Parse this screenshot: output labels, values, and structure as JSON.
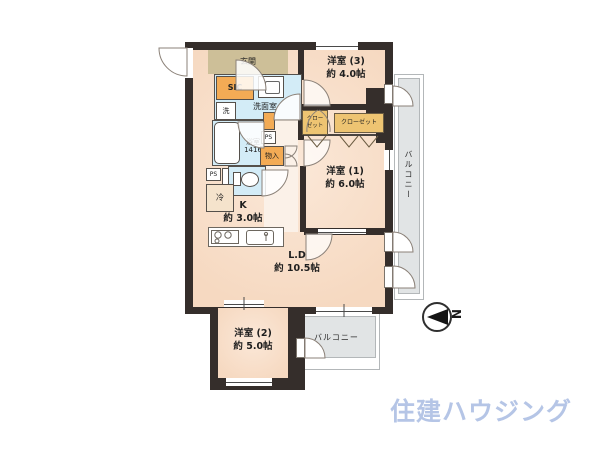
{
  "plan": {
    "labels": {
      "entrance": "玄関",
      "sic": "SIC",
      "washroom": "洗面室",
      "washer": "洗",
      "bath_name": "浴室",
      "bath_size": "1416",
      "ps": "PS",
      "storage": "物入",
      "fridge": "冷",
      "kitchen_name": "K",
      "kitchen_area": "約 3.0帖",
      "ld_name": "L.D",
      "ld_area": "約 10.5帖",
      "w1_name": "洋室 (1)",
      "w1_area": "約 6.0帖",
      "w2_name": "洋室 (2)",
      "w2_area": "約 5.0帖",
      "w3_name": "洋室 (3)",
      "w3_area": "約 4.0帖",
      "closet_small_line1": "クロー",
      "closet_small_line2": "ゼット",
      "closet_wide": "クローゼット",
      "balcony_right": "バルコニー",
      "balcony_bottom": "バルコニー"
    },
    "compass": {
      "north": "N"
    },
    "colors": {
      "wall": "#352e2b",
      "floor": "#f6d9c1",
      "wet_area": "#d3ecf7",
      "accent_orange": "#f3ab55",
      "closet": "#eec472",
      "entrance_tan": "#cdbf98",
      "balcony_grey": "#e1e4e5",
      "logo_blue": "#b5c5e6"
    }
  },
  "footer": {
    "logo": "住建ハウジング"
  }
}
